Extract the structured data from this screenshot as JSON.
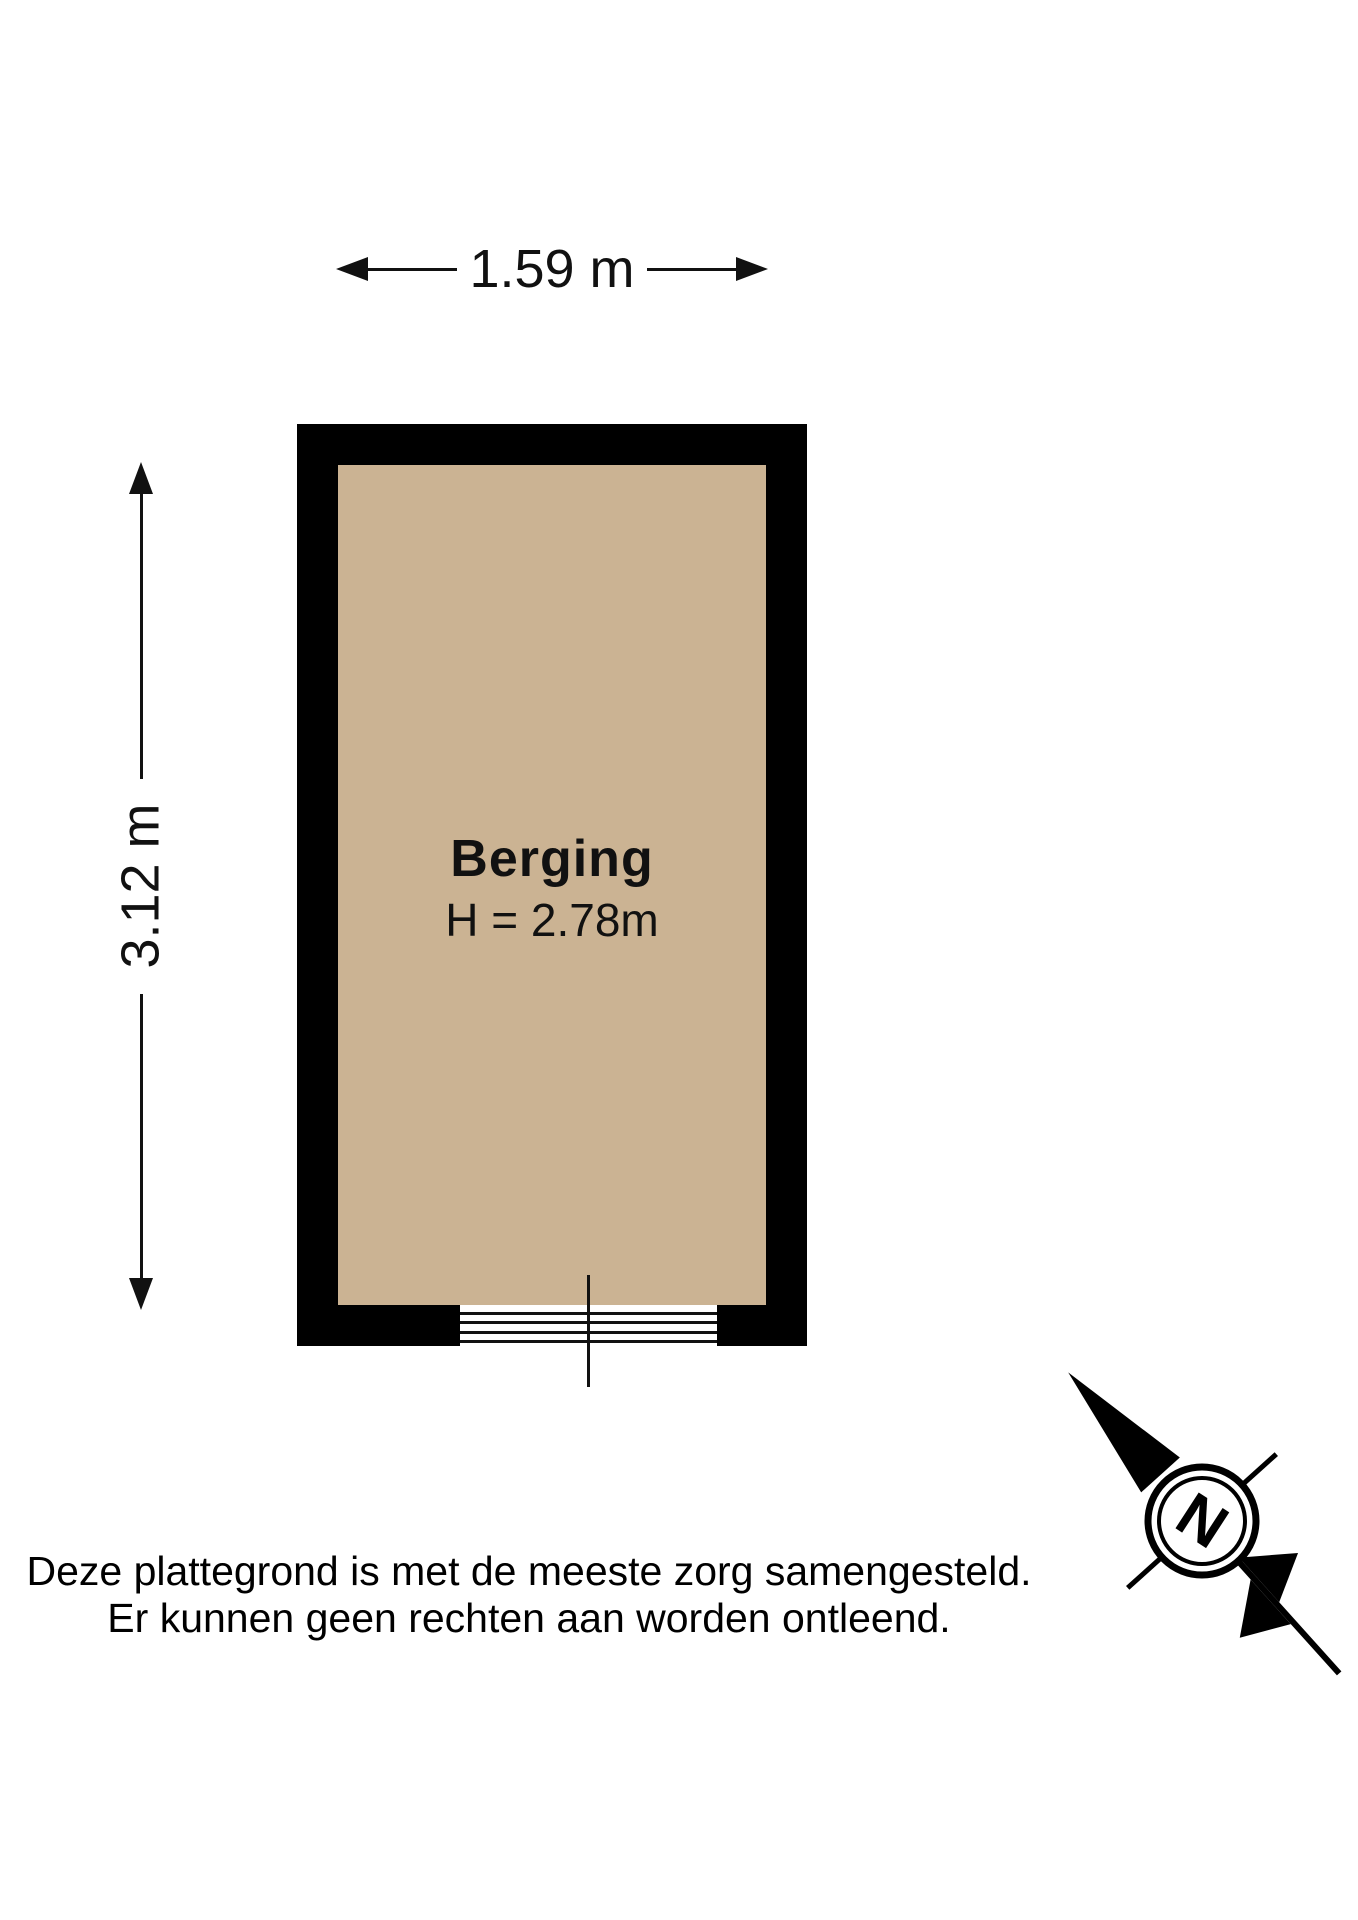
{
  "floorplan": {
    "room": {
      "name": "Berging",
      "ceiling_height": "H = 2.78m"
    },
    "dimensions": {
      "width": "1.59 m",
      "depth": "3.12 m"
    },
    "compass": {
      "north": "N"
    },
    "colors": {
      "wall": "#000000",
      "floor": "#cbb393",
      "line": "#111111",
      "background": "#ffffff"
    }
  },
  "disclaimer": {
    "line1": "Deze plattegrond is met de meeste zorg samengesteld.",
    "line2": "Er kunnen geen rechten aan worden ontleend."
  }
}
